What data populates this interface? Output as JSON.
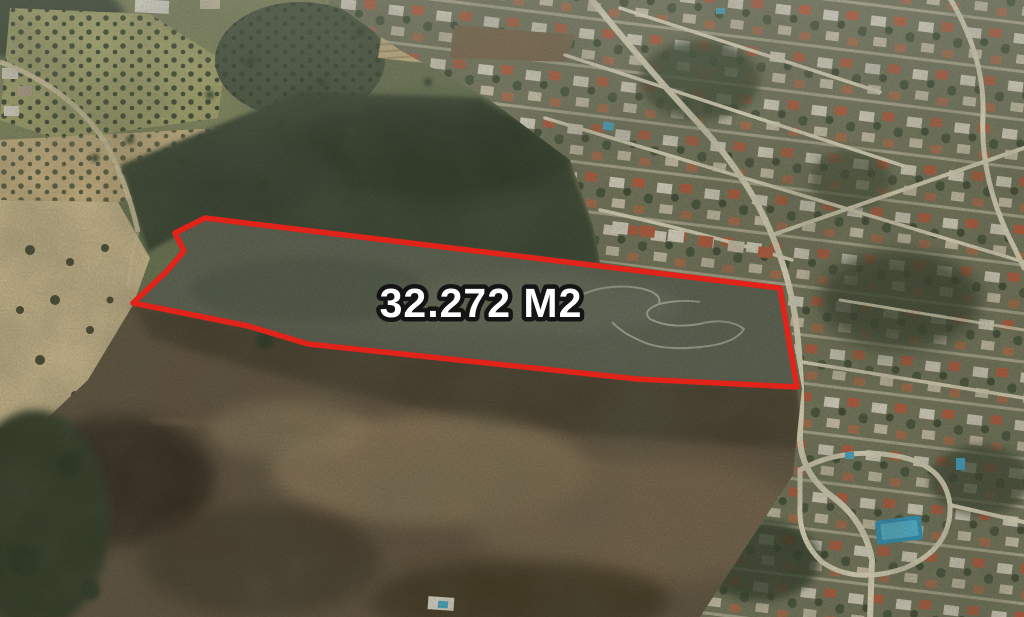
{
  "scene": {
    "view": "aerial-satellite",
    "parcel": {
      "area_label": "32.272 M2",
      "outline_color": "#e1231a",
      "outline_points": "205,218 780,288 797,387 637,379 430,357 308,344 248,326 133,303 166,272 184,251 175,233",
      "label_color": "#ffffff",
      "label_outline_color": "#141414"
    }
  }
}
